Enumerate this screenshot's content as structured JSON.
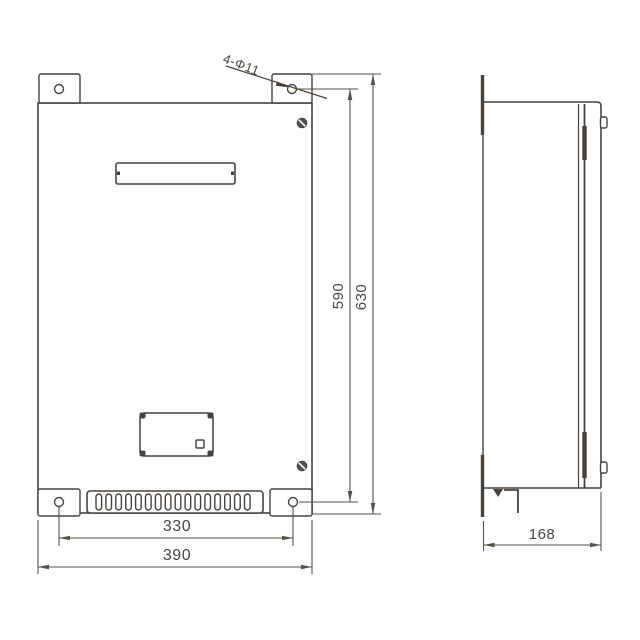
{
  "page": {
    "background": "#ffffff"
  },
  "drawing": {
    "type": "engineering-dimension-drawing",
    "subject": "wall-mounted enclosure cabinet, front view and side view",
    "line_color": "#49423c",
    "dim_color": "#57504a",
    "text_color": "#4d463f",
    "hole_callout": "4-Φ11",
    "front_view": {
      "dim_hole_spacing_x": "330",
      "dim_overall_width": "390",
      "dim_hole_spacing_y": "590",
      "dim_overall_height": "630"
    },
    "side_view": {
      "dim_depth": "168"
    }
  }
}
